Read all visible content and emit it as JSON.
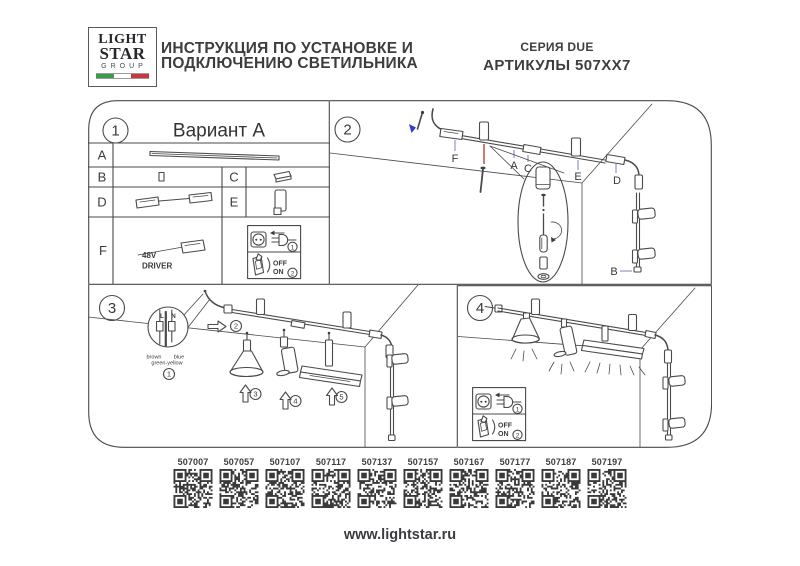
{
  "header": {
    "logo": {
      "line1": "LIGHT",
      "line2": "STAR",
      "line3": "GROUP"
    },
    "title_line1": "ИНСТРУКЦИЯ ПО УСТАНОВКЕ И",
    "title_line2": "ПОДКЛЮЧЕНИЮ СВЕТИЛЬНИКА",
    "series": "СЕРИЯ DUE",
    "articles": "АРТИКУЛЫ 507XX7"
  },
  "panel1": {
    "number": "1",
    "title": "Вариант А",
    "rows": {
      "a": "A",
      "b": "B",
      "c": "C",
      "d": "D",
      "e": "E",
      "f": "F"
    },
    "driver_line1": "48V",
    "driver_line2": "DRIVER"
  },
  "panel2": {
    "number": "2",
    "labels": {
      "f": "F",
      "a": "A",
      "c": "C",
      "e": "E",
      "d": "D",
      "b": "B"
    }
  },
  "panel3": {
    "number": "3",
    "wire": {
      "l": "L",
      "n": "N",
      "brown": "brown",
      "blue": "blue",
      "green_yellow": "green-yellow"
    },
    "steps": {
      "s1": "1",
      "s2": "2",
      "s3": "3",
      "s4": "4",
      "s5": "5"
    }
  },
  "panel4": {
    "number": "4"
  },
  "plug_switch": {
    "step1": "1",
    "step2": "2",
    "off": "OFF",
    "on": "ON"
  },
  "qr": {
    "items": [
      {
        "article": "507007"
      },
      {
        "article": "507057"
      },
      {
        "article": "507107"
      },
      {
        "article": "507117"
      },
      {
        "article": "507137"
      },
      {
        "article": "507157"
      },
      {
        "article": "507167"
      },
      {
        "article": "507177"
      },
      {
        "article": "507187"
      },
      {
        "article": "507197"
      }
    ]
  },
  "footer": {
    "website": "www.lightstar.ru"
  },
  "colors": {
    "ink": "#3c3c3c",
    "line": "#4a4a4a",
    "leader": "#8d96d2",
    "accent_red": "#b5524a",
    "accent_blue": "#2b3fd4",
    "flag_green": "#3f9b4c",
    "flag_red": "#c8373e",
    "qr_dark": "#3a3a3a"
  }
}
